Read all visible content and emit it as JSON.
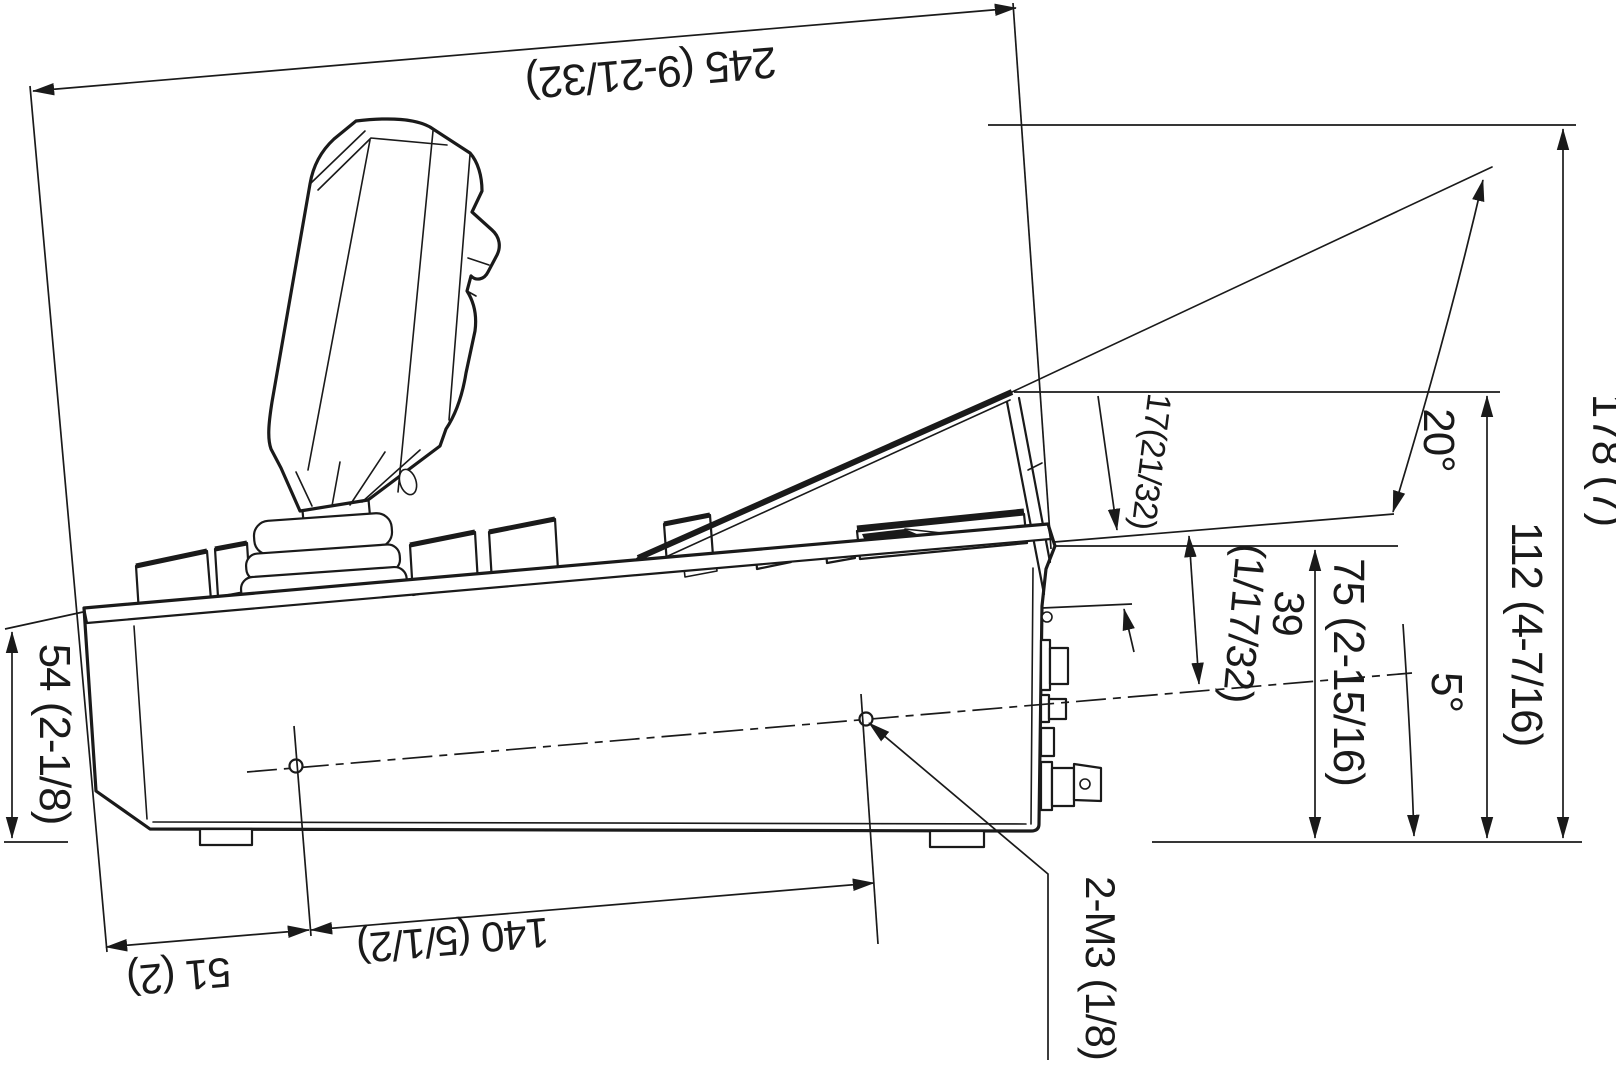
{
  "drawing": {
    "labels": {
      "width_overall": "245 (9-21/32)",
      "height_overall": "178 (7)",
      "height_panel_top": "112 (4-7/16)",
      "height_rear": "75 (2-15/16)",
      "height_front": "54 (2-1/8)",
      "angle_panel": "20°",
      "angle_base": "5°",
      "dim_surface_to_axis_line1": "39",
      "dim_surface_to_axis_line2": "(1/17/32)",
      "dim_panel_gap": "17(21/32)",
      "dim_hole_front": "51 (2)",
      "dim_hole_spacing": "140 (5/1/2)",
      "screw_holes": "2-M3 (1/8)"
    },
    "colors": {
      "line": "#1a1a1a",
      "background": "#ffffff"
    }
  }
}
